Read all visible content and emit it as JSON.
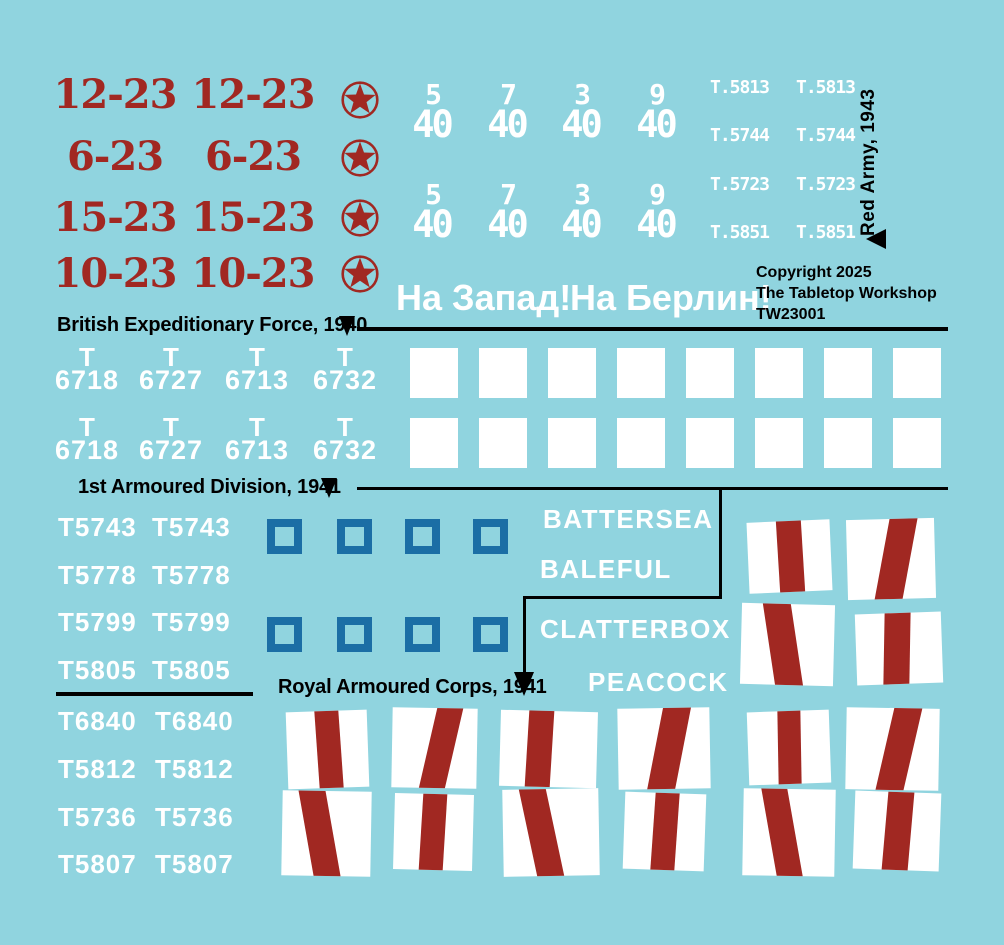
{
  "sheet": {
    "bg_color": "#90D4DF",
    "width": 1004,
    "height": 945
  },
  "colors": {
    "red": "#A12822",
    "blue": "#1B6EA5",
    "white": "#FFFFFF",
    "black": "#000000"
  },
  "red_army": {
    "side_label": "Red Army, 1943",
    "marker_icon": "triangle-left-icon",
    "roundel_icon": "star-in-circle-icon",
    "serial_rows": [
      {
        "left": "12-23",
        "right": "12-23"
      },
      {
        "left": "6-23",
        "right": "6-23"
      },
      {
        "left": "15-23",
        "right": "15-23"
      },
      {
        "left": "10-23",
        "right": "10-23"
      }
    ],
    "fractions": [
      {
        "num": "5",
        "den": "40"
      },
      {
        "num": "7",
        "den": "40"
      },
      {
        "num": "3",
        "den": "40"
      },
      {
        "num": "9",
        "den": "40"
      }
    ],
    "t_serials": [
      "T.5813",
      "T.5744",
      "T.5723",
      "T.5851"
    ],
    "slogans": [
      "На Запад!",
      "На Берлин!"
    ]
  },
  "copyright": {
    "lines": [
      "Copyright 2025",
      "The Tabletop Workshop",
      "TW23001"
    ]
  },
  "sections": {
    "bef": {
      "title": "British Expeditionary Force, 1940",
      "marker_icon": "triangle-down-icon",
      "serials": [
        {
          "prefix": "T",
          "number": "6718"
        },
        {
          "prefix": "T",
          "number": "6727"
        },
        {
          "prefix": "T",
          "number": "6713"
        },
        {
          "prefix": "T",
          "number": "6732"
        }
      ],
      "squares": {
        "shape": "white-filled-square",
        "rows": 2,
        "per_row": 8
      }
    },
    "armoured": {
      "title": "1st Armoured Division, 1941",
      "marker_icon": "triangle-down-icon",
      "serials": [
        "T5743",
        "T5778",
        "T5799",
        "T5805"
      ],
      "squares": {
        "shape": "blue-outline-square",
        "rows": 2,
        "per_row": 4
      },
      "names": [
        "BATTERSEA",
        "BALEFUL",
        "CLATTERBOX",
        "PEACOCK"
      ]
    },
    "rac": {
      "title": "Royal Armoured Corps, 1941",
      "marker_icon": "triangle-down-icon",
      "serials": [
        "T6840",
        "T5812",
        "T5736",
        "T5807"
      ]
    }
  },
  "flags": {
    "shape": "white-flag-red-stripe",
    "items": [
      {
        "x": 748,
        "y": 521,
        "w": 83,
        "h": 71,
        "rot": -2.5,
        "skew": 1,
        "sl": 36,
        "sw": 30
      },
      {
        "x": 847,
        "y": 519,
        "w": 88,
        "h": 80,
        "rot": -1.5,
        "skew": -12,
        "sl": 40,
        "sw": 32
      },
      {
        "x": 741,
        "y": 604,
        "w": 93,
        "h": 81,
        "rot": 1.5,
        "skew": 10,
        "sl": 30,
        "sw": 30
      },
      {
        "x": 856,
        "y": 613,
        "w": 86,
        "h": 71,
        "rot": -2,
        "skew": -3,
        "sl": 33,
        "sw": 30
      },
      {
        "x": 287,
        "y": 711,
        "w": 81,
        "h": 77,
        "rot": -2,
        "skew": 2,
        "sl": 37,
        "sw": 30
      },
      {
        "x": 392,
        "y": 708,
        "w": 85,
        "h": 80,
        "rot": 1,
        "skew": -12,
        "sl": 42,
        "sw": 30
      },
      {
        "x": 500,
        "y": 711,
        "w": 97,
        "h": 76,
        "rot": 1.5,
        "skew": -2,
        "sl": 28,
        "sw": 26
      },
      {
        "x": 618,
        "y": 708,
        "w": 92,
        "h": 81,
        "rot": -1,
        "skew": -12,
        "sl": 40,
        "sw": 30
      },
      {
        "x": 748,
        "y": 711,
        "w": 82,
        "h": 73,
        "rot": -2,
        "skew": -1,
        "sl": 36,
        "sw": 28
      },
      {
        "x": 846,
        "y": 708,
        "w": 93,
        "h": 82,
        "rot": 1,
        "skew": -12,
        "sl": 42,
        "sw": 30
      },
      {
        "x": 282,
        "y": 791,
        "w": 89,
        "h": 85,
        "rot": 1,
        "skew": 11,
        "sl": 27,
        "sw": 30
      },
      {
        "x": 394,
        "y": 794,
        "w": 79,
        "h": 76,
        "rot": 1.5,
        "skew": -2,
        "sl": 34,
        "sw": 30
      },
      {
        "x": 503,
        "y": 789,
        "w": 96,
        "h": 87,
        "rot": -1,
        "skew": 11,
        "sl": 26,
        "sw": 28
      },
      {
        "x": 624,
        "y": 793,
        "w": 81,
        "h": 77,
        "rot": 2,
        "skew": -2,
        "sl": 36,
        "sw": 30
      },
      {
        "x": 743,
        "y": 789,
        "w": 92,
        "h": 87,
        "rot": 1,
        "skew": 11,
        "sl": 28,
        "sw": 28
      },
      {
        "x": 854,
        "y": 792,
        "w": 86,
        "h": 78,
        "rot": 2,
        "skew": -3,
        "sl": 36,
        "sw": 30
      }
    ]
  }
}
